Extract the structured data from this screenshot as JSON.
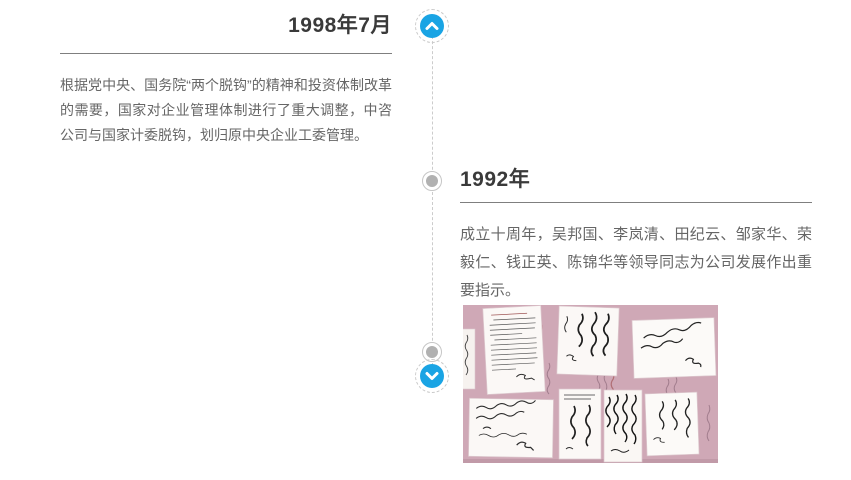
{
  "page": {
    "background_color": "#ffffff"
  },
  "timeline": {
    "accent_color": "#1aa4e4",
    "line_color": "#cccccc",
    "dot_color": "#b1b1b1",
    "up_icon": "chevron-up-icon",
    "down_icon": "chevron-down-icon"
  },
  "entries": [
    {
      "title": "1998年7月",
      "body": "根据党中央、国务院“两个脱钩”的精神和投资体制改革的需要，国家对企业管理体制进行了重大调整，中咨公司与国家计委脱钩，划归原中央企业工委管理。"
    },
    {
      "title": "1992年",
      "body": "成立十周年，吴邦国、李岚清、田纪云、邹家华、荣毅仁、钱正英、陈锦华等领导同志为公司发展作出重要指示。",
      "photo": {
        "description": "领导题词手迹拼贴照片",
        "background_color": "#cfa8b6"
      }
    }
  ]
}
